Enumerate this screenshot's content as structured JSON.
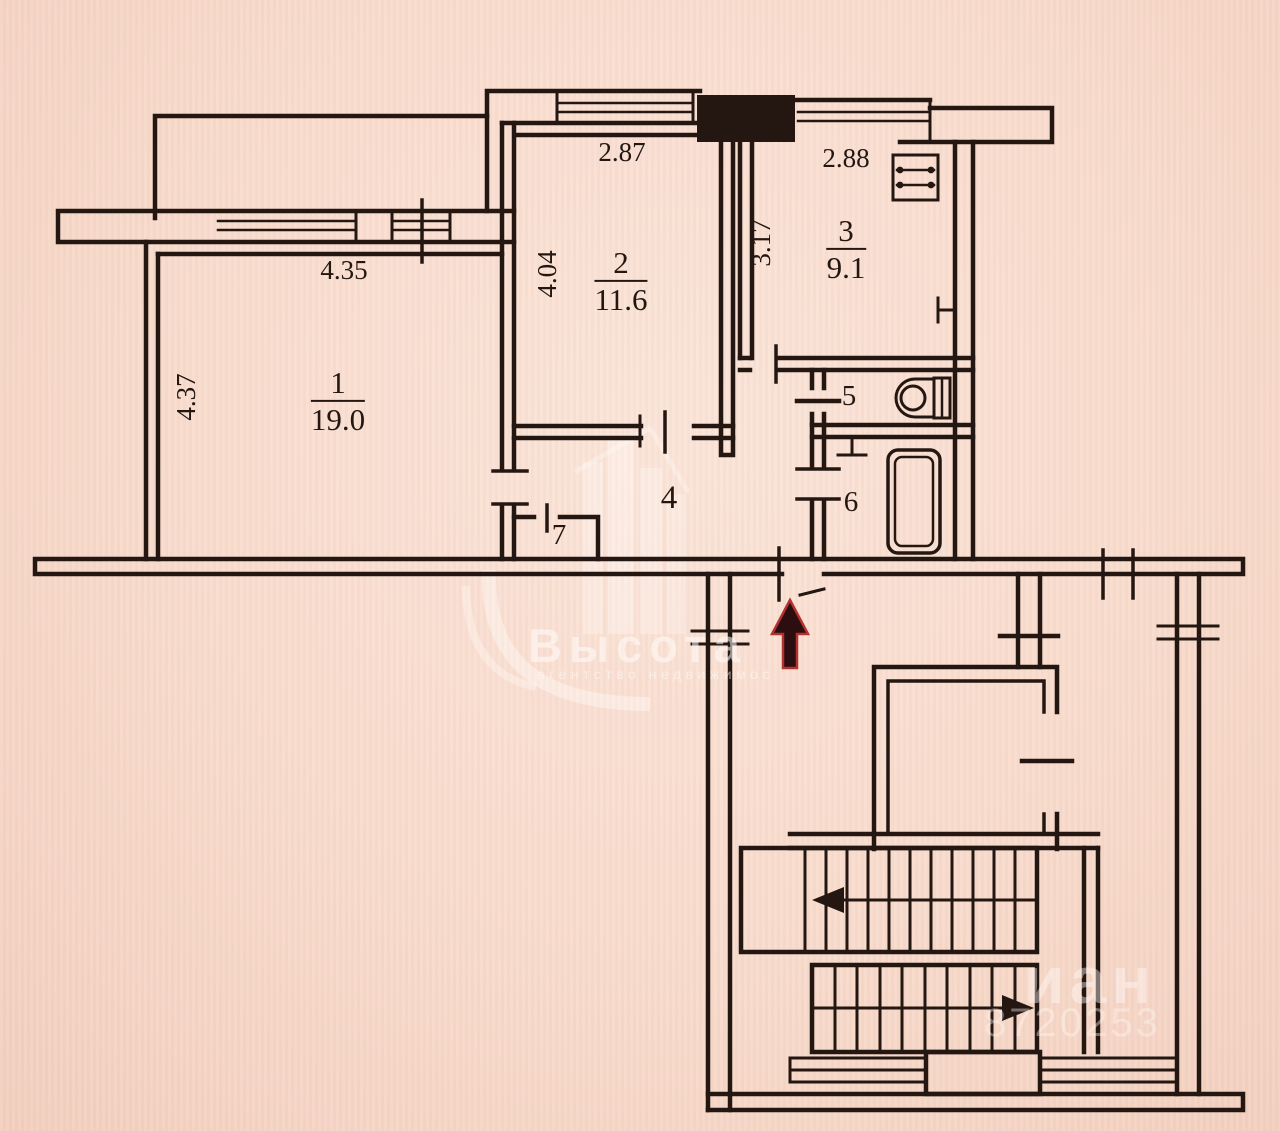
{
  "plan": {
    "type": "apartment-floor-plan",
    "rooms": [
      {
        "number": "1",
        "area": "19.0",
        "dim_width": "4.35",
        "dim_height": "4.37"
      },
      {
        "number": "2",
        "area": "11.6",
        "dim_width": "2.87",
        "dim_height": "4.04"
      },
      {
        "number": "3",
        "area": "9.1",
        "dim_width": "2.88",
        "dim_height": "3.17"
      },
      {
        "number": "4"
      },
      {
        "number": "5"
      },
      {
        "number": "6"
      },
      {
        "number": "7"
      }
    ],
    "icons": [
      "stove-icon",
      "toilet-icon",
      "bathtub-icon",
      "sink-icon",
      "heater-icon",
      "entrance-arrow-icon",
      "stairs-flight-icon",
      "elevator-shaft",
      "window-symbol"
    ]
  },
  "watermarks": {
    "agency_name": "Высота",
    "agency_tagline": "агентство недвижимос",
    "listing_site_fragment": "иан",
    "listing_id_fragment": "8720253"
  },
  "colors": {
    "paper": "#f9dccd",
    "ink": "#241712",
    "arrow_red": "#b23230"
  }
}
